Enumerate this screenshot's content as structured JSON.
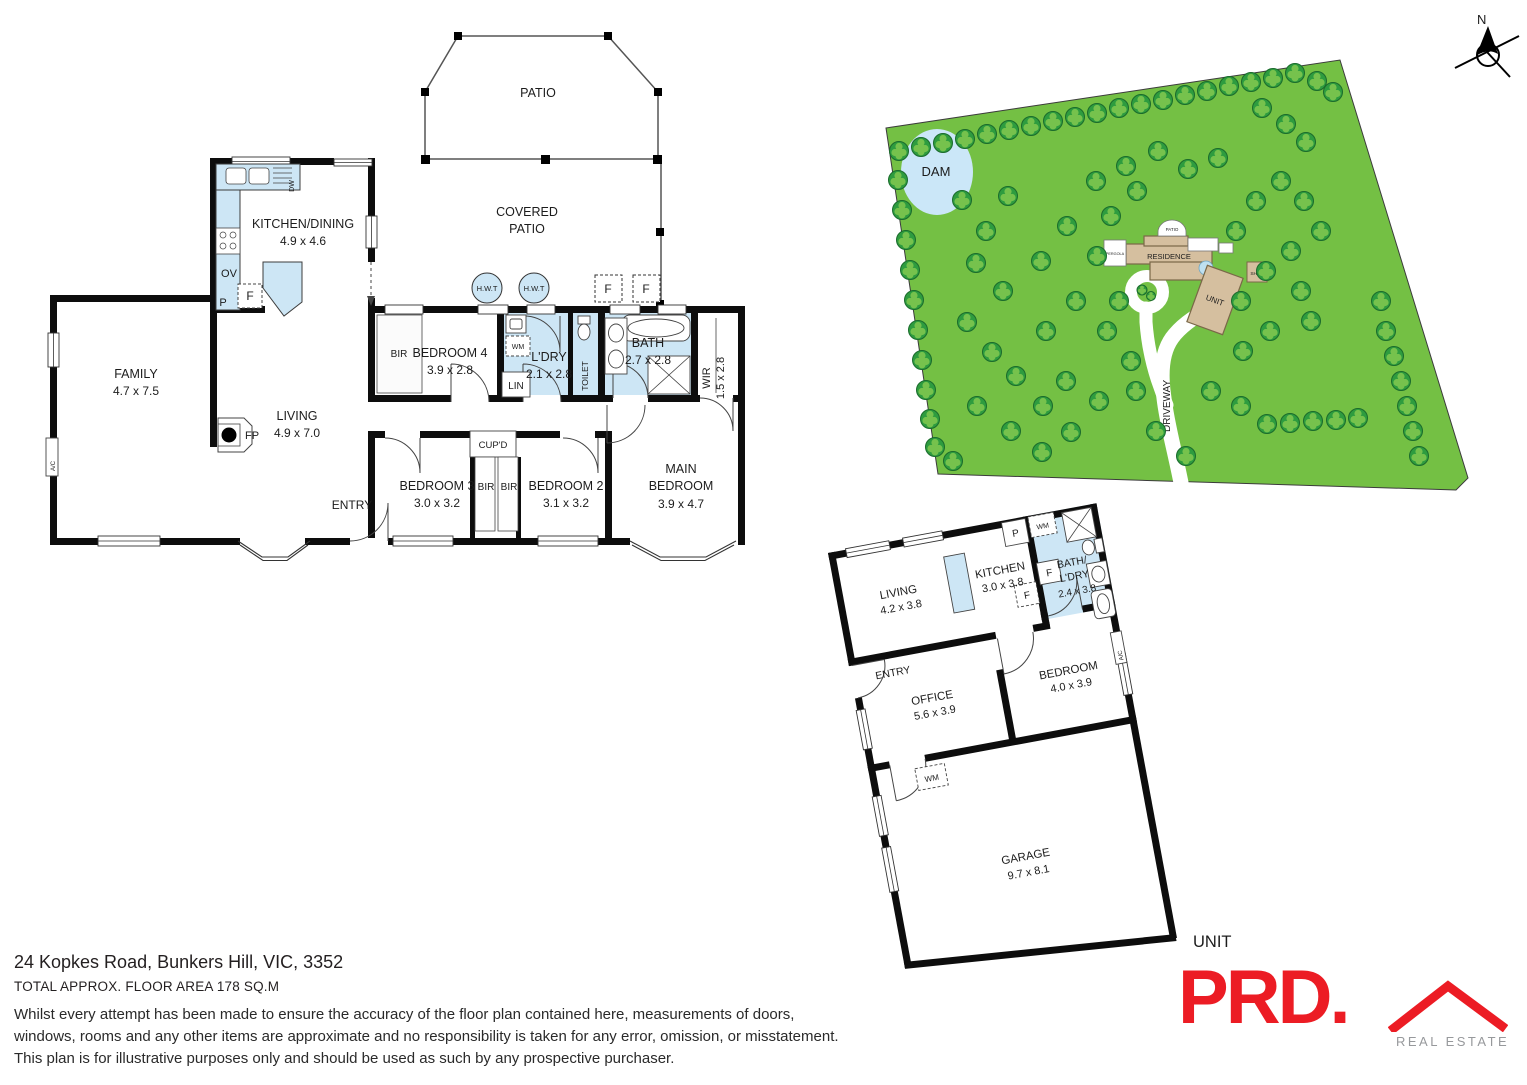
{
  "footer": {
    "address": "24 Kopkes Road, Bunkers Hill, VIC, 3352",
    "area_line": "TOTAL APPROX. FLOOR AREA 178 SQ.M",
    "disclaimer": [
      "Whilst every attempt has been made to ensure the accuracy of the floor plan contained here, measurements of doors,",
      "windows, rooms and any other items are approximate and no responsibility is taken for any error, omission, or misstatement.",
      "This plan is for illustrative purposes only and should be used as such by any prospective purchaser."
    ]
  },
  "logo": {
    "brand": "PRD.",
    "tagline": "REAL ESTATE"
  },
  "compass": {
    "label": "N"
  },
  "main_plan": {
    "rooms": {
      "patio": "PATIO",
      "covered1": "COVERED",
      "covered2": "PATIO",
      "kitchen": {
        "name": "KITCHEN/DINING",
        "dims": "4.9 x 4.6"
      },
      "family": {
        "name": "FAMILY",
        "dims": "4.7 x 7.5"
      },
      "living": {
        "name": "LIVING",
        "dims": "4.9 x 7.0"
      },
      "bedroom4": {
        "name": "BEDROOM 4",
        "dims": "3.9 x 2.8"
      },
      "laundry": {
        "name": "L'DRY",
        "dims": "2.1 x 2.8"
      },
      "bath": {
        "name": "BATH",
        "dims": "2.7 x 2.8"
      },
      "toilet": "TOILET",
      "wir": {
        "name": "WIR",
        "dims": "1.5 x 2.8"
      },
      "bedroom3": {
        "name": "BEDROOM 3",
        "dims": "3.0 x 3.2"
      },
      "bedroom2": {
        "name": "BEDROOM 2",
        "dims": "3.1 x 3.2"
      },
      "main_bedroom": {
        "line1": "MAIN",
        "line2": "BEDROOM",
        "dims": "3.9 x 4.7"
      },
      "entry": "ENTRY"
    },
    "fix": {
      "bir": "BIR",
      "cupd": "CUP'D",
      "lin": "LIN",
      "wm": "WM",
      "ov": "OV",
      "p": "P",
      "f": "F",
      "dw": "DW",
      "fp": "FP",
      "hwt": "H.W.T",
      "ac": "A/C"
    }
  },
  "unit_plan": {
    "caption": "UNIT",
    "rooms": {
      "living": {
        "name": "LIVING",
        "dims": "4.2 x 3.8"
      },
      "kitchen": {
        "name": "KITCHEN",
        "dims": "3.0 x 3.8"
      },
      "bath": {
        "line1": "BATH/",
        "line2": "L'DRY",
        "dims": "2.4 x 3.8"
      },
      "office": {
        "name": "OFFICE",
        "dims": "5.6 x 3.9"
      },
      "bedroom": {
        "name": "BEDROOM",
        "dims": "4.0 x 3.9"
      },
      "garage": {
        "name": "GARAGE",
        "dims": "9.7 x 8.1"
      },
      "entry": "ENTRY"
    },
    "fix": {
      "p": "P",
      "wm": "WM",
      "f": "F",
      "ac": "A/C"
    }
  },
  "site_plan": {
    "labels": {
      "dam": "DAM",
      "residence": "RESIDENCE",
      "unit": "UNIT",
      "shed": "SHED",
      "driveway": "DRIVEWAY",
      "patio": "PATIO",
      "pergola": "PERGOLA"
    },
    "colors": {
      "land": "#74C044",
      "tree": "#2E9C3F",
      "tree_light": "#76C24D",
      "dam": "#CBE7F8",
      "building": "#D5BF9F",
      "wet_room": "#CDE6F5",
      "brand_red": "#EC1C24",
      "brand_gray": "#97999C"
    },
    "trees": [
      [
        899,
        151
      ],
      [
        921,
        147
      ],
      [
        943,
        143
      ],
      [
        965,
        139
      ],
      [
        987,
        134
      ],
      [
        1009,
        130
      ],
      [
        1031,
        126
      ],
      [
        1053,
        121
      ],
      [
        1075,
        117
      ],
      [
        1097,
        113
      ],
      [
        1119,
        108
      ],
      [
        1141,
        104
      ],
      [
        1163,
        100
      ],
      [
        1185,
        95
      ],
      [
        1207,
        91
      ],
      [
        1229,
        86
      ],
      [
        1251,
        82
      ],
      [
        1273,
        78
      ],
      [
        1295,
        73
      ],
      [
        1317,
        81
      ],
      [
        1333,
        92
      ],
      [
        1262,
        108
      ],
      [
        1286,
        124
      ],
      [
        1306,
        142
      ],
      [
        898,
        180
      ],
      [
        902,
        210
      ],
      [
        906,
        240
      ],
      [
        910,
        270
      ],
      [
        914,
        300
      ],
      [
        918,
        330
      ],
      [
        922,
        360
      ],
      [
        926,
        390
      ],
      [
        930,
        419
      ],
      [
        935,
        447
      ],
      [
        953,
        461
      ],
      [
        962,
        200
      ],
      [
        986,
        231
      ],
      [
        1008,
        196
      ],
      [
        976,
        263
      ],
      [
        1003,
        291
      ],
      [
        967,
        322
      ],
      [
        992,
        352
      ],
      [
        1016,
        376
      ],
      [
        977,
        406
      ],
      [
        1011,
        431
      ],
      [
        1042,
        452
      ],
      [
        1071,
        432
      ],
      [
        1043,
        406
      ],
      [
        1066,
        381
      ],
      [
        1099,
        401
      ],
      [
        1046,
        331
      ],
      [
        1076,
        301
      ],
      [
        1041,
        261
      ],
      [
        1067,
        226
      ],
      [
        1096,
        181
      ],
      [
        1126,
        166
      ],
      [
        1158,
        151
      ],
      [
        1188,
        169
      ],
      [
        1218,
        158
      ],
      [
        1111,
        216
      ],
      [
        1137,
        191
      ],
      [
        1097,
        256
      ],
      [
        1119,
        301
      ],
      [
        1107,
        331
      ],
      [
        1131,
        361
      ],
      [
        1156,
        431
      ],
      [
        1186,
        456
      ],
      [
        1136,
        391
      ],
      [
        1211,
        391
      ],
      [
        1241,
        406
      ],
      [
        1267,
        424
      ],
      [
        1290,
        423
      ],
      [
        1313,
        421
      ],
      [
        1336,
        420
      ],
      [
        1358,
        418
      ],
      [
        1243,
        351
      ],
      [
        1270,
        331
      ],
      [
        1241,
        301
      ],
      [
        1266,
        271
      ],
      [
        1291,
        251
      ],
      [
        1236,
        231
      ],
      [
        1256,
        201
      ],
      [
        1281,
        181
      ],
      [
        1304,
        201
      ],
      [
        1321,
        231
      ],
      [
        1301,
        291
      ],
      [
        1311,
        321
      ],
      [
        1381,
        301
      ],
      [
        1386,
        331
      ],
      [
        1394,
        356
      ],
      [
        1401,
        381
      ],
      [
        1407,
        406
      ],
      [
        1413,
        431
      ],
      [
        1419,
        456
      ],
      [
        1142,
        290,
        5
      ],
      [
        1151,
        296,
        4.5
      ]
    ]
  }
}
